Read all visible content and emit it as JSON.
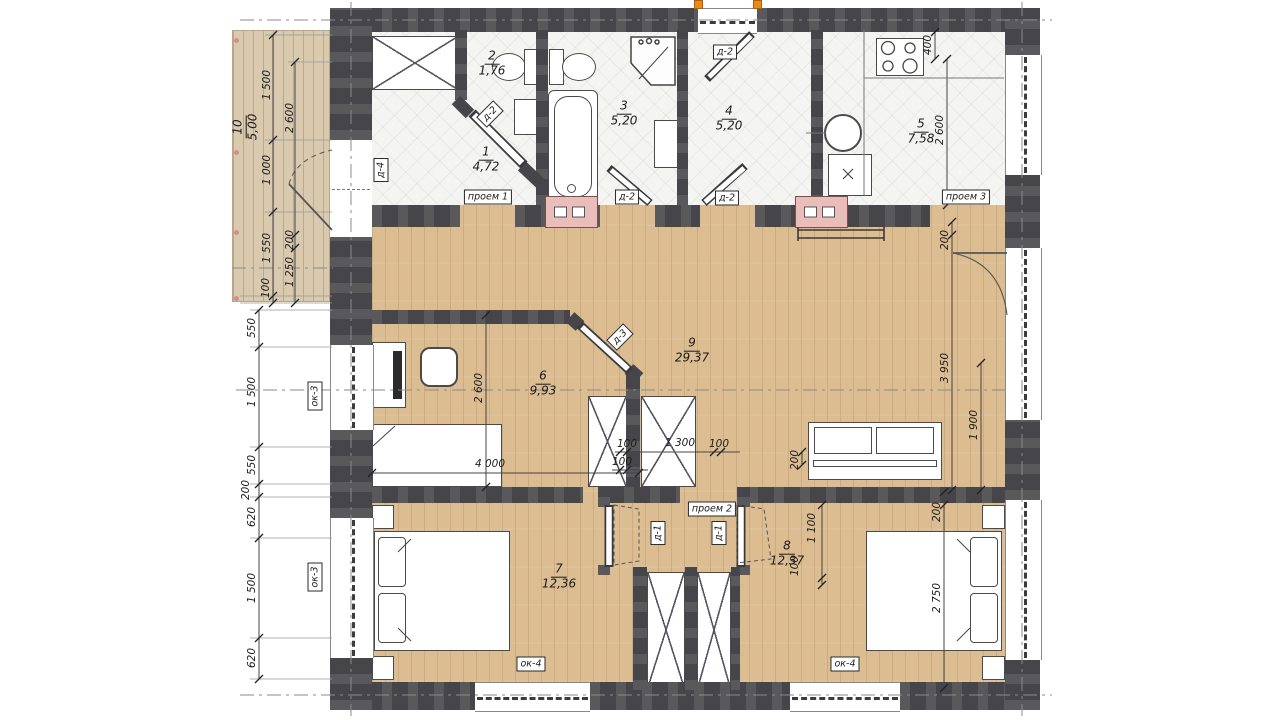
{
  "rooms": [
    {
      "num": "1",
      "area": "4,72"
    },
    {
      "num": "2",
      "area": "1,76"
    },
    {
      "num": "3",
      "area": "5,20"
    },
    {
      "num": "4",
      "area": "5,20"
    },
    {
      "num": "5",
      "area": "7,58"
    },
    {
      "num": "6",
      "area": "9,93"
    },
    {
      "num": "7",
      "area": "12,36"
    },
    {
      "num": "8",
      "area": "12,37"
    },
    {
      "num": "9",
      "area": "29,37"
    },
    {
      "num": "10",
      "area": "5,00"
    }
  ],
  "tags": {
    "proem1": "проем 1",
    "proem2": "проем 2",
    "proem3": "проем 3",
    "d1": "д-1",
    "d2": "д-2",
    "d3": "д-3",
    "d4": "д-4",
    "ok3": "ок-3",
    "ok4": "ок-4"
  },
  "dims": [
    "1 500",
    "1 000",
    "1 550",
    "100",
    "2 600",
    "200",
    "1 250",
    "550",
    "1 500",
    "550",
    "200",
    "620",
    "1 500",
    "620",
    "200",
    "3 950",
    "1 900",
    "200",
    "2 750",
    "400",
    "2 600",
    "2 600",
    "4 000",
    "100",
    "1 300",
    "100",
    "100",
    "1 100",
    "100",
    "200"
  ],
  "palette": {
    "wood": "#dcbd92",
    "tile": "#f4f4f3",
    "wall": "#46464a",
    "vent_pink": "#e9bdb9",
    "entry_orange": "#e8891a"
  }
}
